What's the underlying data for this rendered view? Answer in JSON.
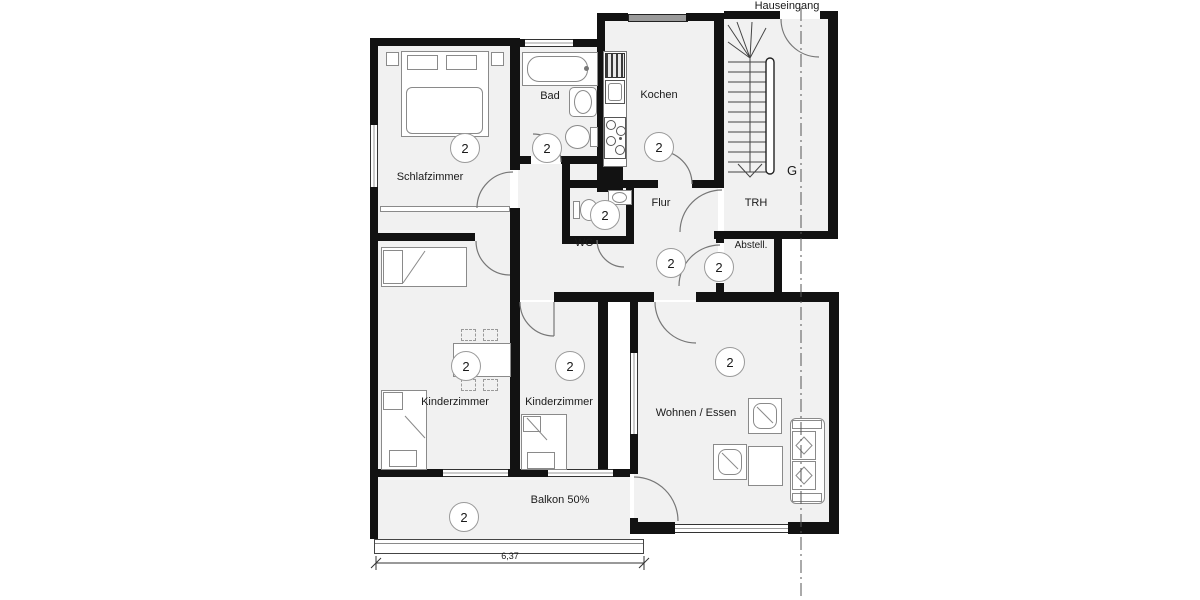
{
  "plan": {
    "entrance_label": "Hauseingang",
    "grid_label": "G",
    "unit_badge": "2",
    "dimension": "6,37",
    "rooms": [
      {
        "name": "Schlafzimmer"
      },
      {
        "name": "Bad"
      },
      {
        "name": "Kochen"
      },
      {
        "name": "WC"
      },
      {
        "name": "Flur"
      },
      {
        "name": "Abstell."
      },
      {
        "name": "TRH"
      },
      {
        "name": "Kinderzimmer"
      },
      {
        "name": "Kinderzimmer"
      },
      {
        "name": "Wohnen / Essen"
      },
      {
        "name": "Balkon 50%"
      }
    ],
    "colors": {
      "wall": "#121212",
      "floor": "#f1f1f1",
      "furniture_stroke": "#8a8a8a",
      "window_glass": "#9a9a9a"
    }
  }
}
